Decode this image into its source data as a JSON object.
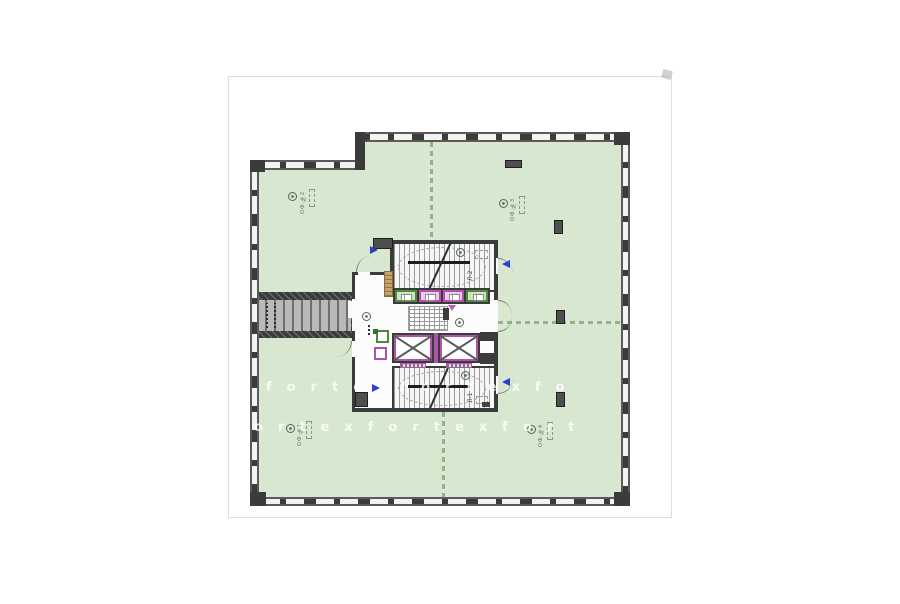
{
  "document": {
    "type": "architectural-floor-plan",
    "sheet_background": "#ffffff"
  },
  "colors": {
    "room_fill": "#d8e7d0",
    "wall": "#3b3b3b",
    "partition_green": "#93b28c",
    "elevator_accent": "#b351ae",
    "cubicle_green_border": "#4c8a3f",
    "cabinet_wood": "#c9a268",
    "arrow_blue": "#2b3fd4",
    "watermark": "#ffffff"
  },
  "rooms": [
    {
      "id": "office-top-left",
      "label": "ОФ.№2"
    },
    {
      "id": "office-top-right",
      "label": "ОФ.№3"
    },
    {
      "id": "office-bottom-left",
      "label": "ОФ.№1"
    },
    {
      "id": "office-bottom-right",
      "label": "ОФ.№4"
    }
  ],
  "core": {
    "stairs": [
      {
        "id": "stair-upper",
        "label": "Л-2"
      },
      {
        "id": "stair-lower",
        "label": "Л-1"
      }
    ],
    "elevator_count": 2,
    "cubicle_colors": [
      "green",
      "magenta",
      "magenta",
      "green"
    ]
  },
  "watermark": {
    "brand": "fortex",
    "rows": [
      "fortexfortexfo",
      "ortexfortexfort"
    ]
  }
}
